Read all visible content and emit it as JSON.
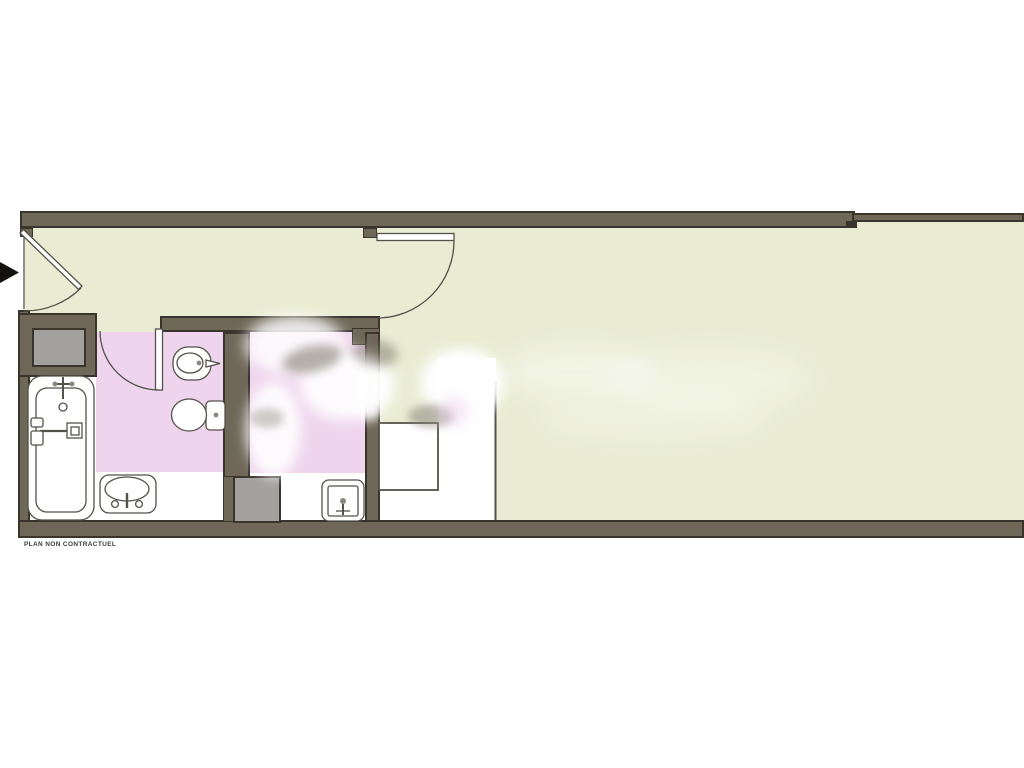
{
  "plan": {
    "disclaimer": "PLAN NON CONTRACTUEL"
  },
  "colors": {
    "paper": "#ffffff",
    "floor": "#e9ecd3",
    "wet-room": "#eed5ed",
    "wall": "#6f6859",
    "wall-edge": "#39342c",
    "shaft": "#a3a19e",
    "line": "#54514a",
    "arrow": "#14120f"
  },
  "symbols": [
    "entrance-arrow-icon",
    "entrance-door-icon",
    "hall-door-icon",
    "bathroom-door-icon",
    "bathtub-icon",
    "washbasin-icon",
    "bidet-icon",
    "toilet-icon",
    "hand-basin-icon",
    "utility-shaft-icon",
    "closet-icon"
  ]
}
